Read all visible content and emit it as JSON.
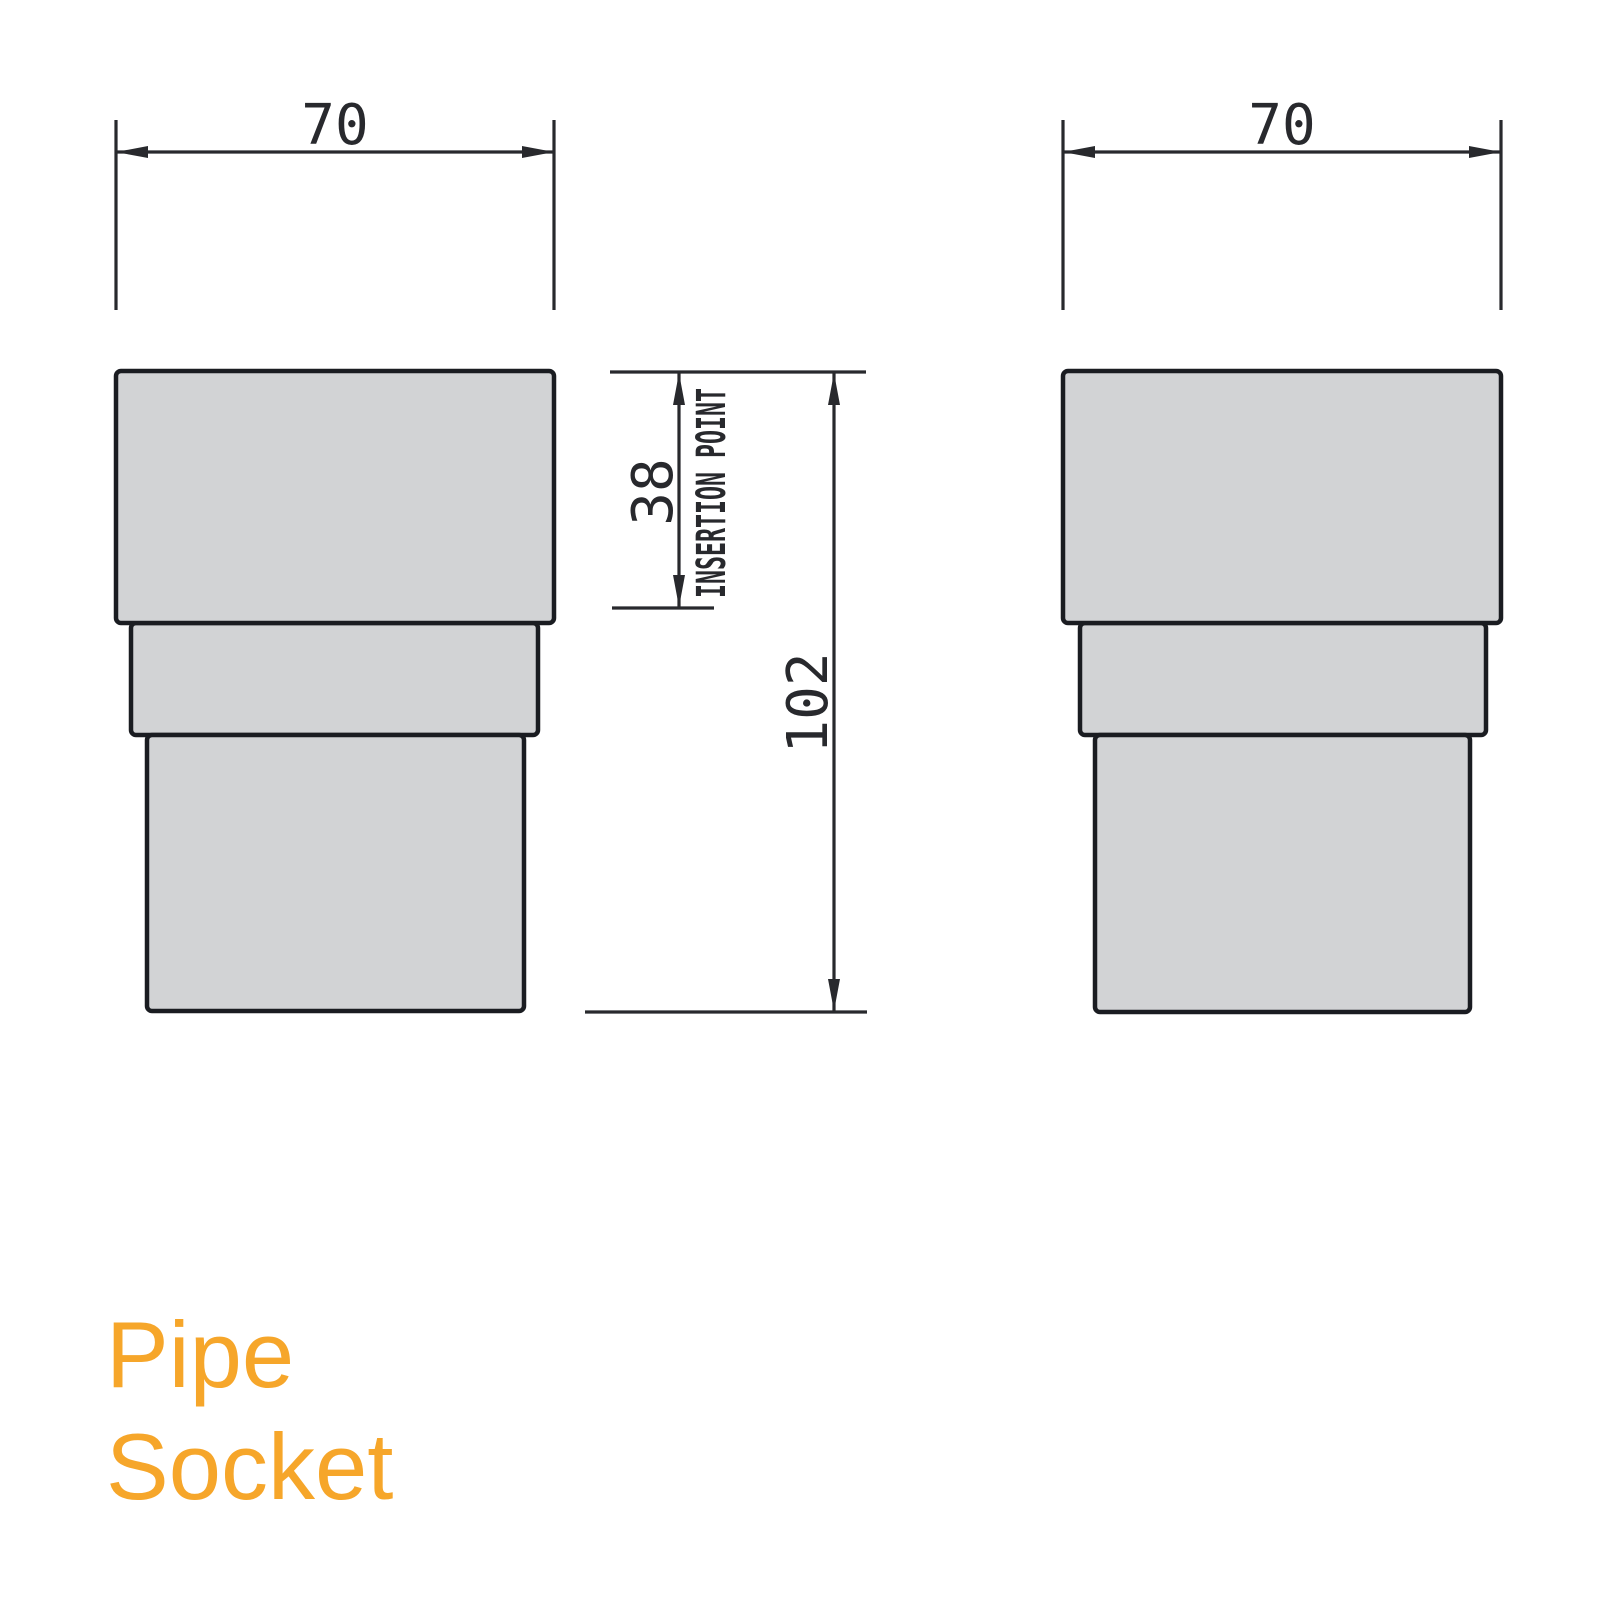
{
  "title": {
    "line1": "Pipe",
    "line2": "Socket"
  },
  "views": {
    "front": {
      "width_dim": "70"
    },
    "side": {
      "width_dim": "70"
    }
  },
  "dims": {
    "insertion_depth": "38",
    "insertion_label": "INSERTION POINT",
    "overall_height": "102"
  },
  "colors": {
    "background": "#FFFFFF",
    "part_fill": "#D2D3D5",
    "part_outline": "#1A1C21",
    "dimension_lines": "#28292D",
    "title_text": "#F6A62A"
  }
}
